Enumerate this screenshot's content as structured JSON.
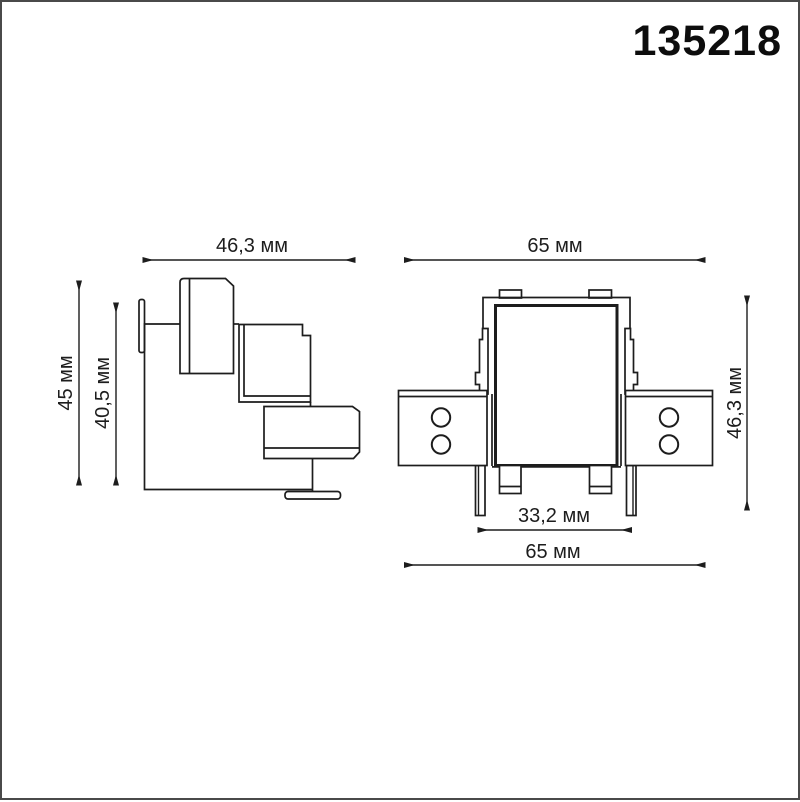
{
  "meta": {
    "background_color": "#ffffff",
    "line_color": "#1d1d1d",
    "page_border_color": "#4a4a4a",
    "unit": "мм"
  },
  "header": {
    "part_number": "135218"
  },
  "drawing": {
    "side_view": {
      "name": "side-profile-view",
      "dim_width": "46,3 мм",
      "dim_height_total": "45 мм",
      "dim_height_inner": "40,5 мм"
    },
    "front_view": {
      "name": "front-view",
      "dim_width_top": "65 мм",
      "dim_height": "46,3 мм",
      "dim_width_inner": "33,2 мм",
      "dim_width_bottom": "65 мм"
    }
  }
}
